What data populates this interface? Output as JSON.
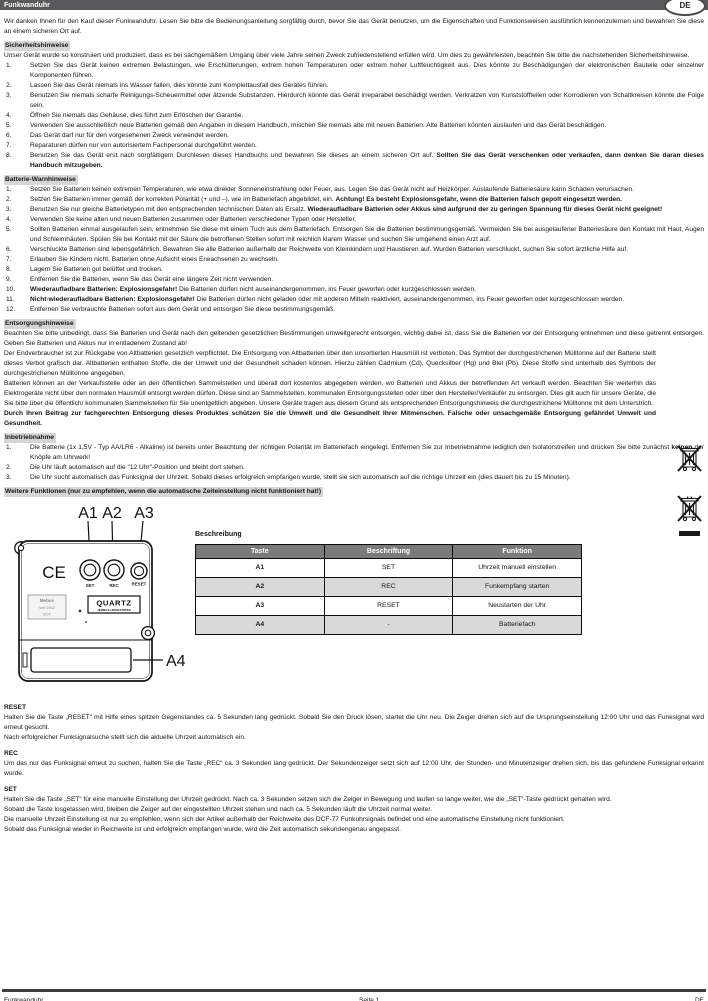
{
  "header": {
    "title": "Funkwanduhr",
    "lang_badge": "DE"
  },
  "intro": "Wir danken Ihnen für den Kauf dieser Funkwanduhr. Lesen Sie bitte die Bedienungsanleitung sorgfältig durch, bevor Sie das Gerät benutzen, um die Eigenschaften und Funktionsweisen ausführlich kennenzulernen und bewahren Sie diese an einem sicheren Ort auf.",
  "safety": {
    "heading": "Sicherheitshinweise",
    "lead": "Unser Gerät wurde so konstruiert und produziert, dass es bei sachgemäßem Umgang über viele Jahre seinen Zweck zufriedenstellend erfüllen wird. Um dies zu gewährleisten, beachten Sie bitte die nachstehenden Sicherheitshinweise.",
    "items": [
      {
        "n": "1.",
        "segs": [
          {
            "t": "Setzen Sie das Gerät keinen extremen Belastungen, wie Erschütterungen, extrem hohen Temperaturen oder extrem hoher Luftfeuchtigkeit aus. Dies könnte zu Beschädigungen der elektronischen Bauteile oder einzelner Komponenten führen."
          }
        ]
      },
      {
        "n": "2.",
        "segs": [
          {
            "t": "Lassen Sie das Gerät niemals ins Wasser fallen, dies könnte zum Komplettausfall des Gerätes führen."
          }
        ]
      },
      {
        "n": "3.",
        "segs": [
          {
            "t": "Benutzen Sie niemals scharfe Reinigungs-Scheuermittel oder ätzende Substanzen. Hierdurch könnte das Gerät irreparabel beschädigt werden. Verkratzen von Kunststoffteilen oder Korrodieren von Schaltkreisen könnte die Folge sein."
          }
        ]
      },
      {
        "n": "4.",
        "segs": [
          {
            "t": "Öffnen Sie niemals das Gehäuse, dies führt zum Erlöschen der Garantie."
          }
        ]
      },
      {
        "n": "5.",
        "segs": [
          {
            "t": "Verwenden Sie ausschließlich neue Batterien gemäß den Angaben in diesem Handbuch, mischen Sie niemals alte mit neuen Batterien. Alte Batterien könnten auslaufen und das Gerät beschädigen."
          }
        ]
      },
      {
        "n": "6.",
        "segs": [
          {
            "t": "Das Gerät darf nur für den vorgesehenen Zweck verwendet werden."
          }
        ]
      },
      {
        "n": "7.",
        "segs": [
          {
            "t": "Reparaturen dürfen nur von autorisiertem Fachpersonal durchgeführt werden."
          }
        ]
      },
      {
        "n": "8.",
        "segs": [
          {
            "t": "Benutzen Sie das Gerät erst nach sorgfältigem Durchlesen dieses Handbuchs und bewahren Sie dieses an einem sicheren Ort auf. "
          },
          {
            "t": "Sollten Sie das Gerät verschenken oder verkaufen, dann denken Sie daran dieses Handbuch mitzugeben.",
            "b": true
          }
        ]
      }
    ]
  },
  "battery": {
    "heading": "Batterie-Warnhinweise",
    "items": [
      {
        "n": "1.",
        "segs": [
          {
            "t": "Setzen Sie Batterien keinen extremen Temperaturen, wie etwa direkter Sonneneinstrahlung oder Feuer, aus. Legen Sie das Gerät nicht auf Heizkörper. Auslaufende Batteriesäure kann Schäden verursachen."
          }
        ]
      },
      {
        "n": "2.",
        "segs": [
          {
            "t": "Setzen Sie Batterien immer gemäß der korrekten Polarität (+ und –), wie im Batteriefach abgebildet, ein. "
          },
          {
            "t": "Achtung! Es besteht Explosionsgefahr, wenn die Batterien falsch gepolt eingesetzt werden.",
            "b": true
          }
        ]
      },
      {
        "n": "3.",
        "segs": [
          {
            "t": "Benutzen Sie nur gleiche Batterietypen mit den entsprechenden technischen Daten als Ersatz. "
          },
          {
            "t": "Wiederaufladbare Batterien oder Akkus sind aufgrund der zu geringen Spannung für dieses Gerät nicht geeignet!",
            "b": true
          }
        ]
      },
      {
        "n": "4.",
        "segs": [
          {
            "t": "Verwenden Sie keine alten und neuen Batterien zusammen oder Batterien verschiedener Typen oder Hersteller."
          }
        ]
      },
      {
        "n": "5.",
        "segs": [
          {
            "t": "Sollten Batterien einmal ausgelaufen sein, entnehmen Sie diese mit einem Tuch aus dem Batteriefach. Entsorgen Sie die Batterien bestimmungsgemäß. Vermeiden Sie bei ausgelaufener Batteriesäure den Kontakt mit Haut, Augen und Schleimhäuten. Spülen Sie bei Kontakt mit der Säure die betroffenen Stellen sofort mit reichlich klarem Wasser und suchen Sie umgehend einen Arzt auf."
          }
        ]
      },
      {
        "n": "6.",
        "segs": [
          {
            "t": "Verschluckte Batterien sind lebensgefährlich. Bewahren Sie alle Batterien außerhalb der Reichweite von Kleinkindern und Haustieren auf. Wurden Batterien verschluckt, suchen Sie sofort ärztliche Hilfe auf."
          }
        ]
      },
      {
        "n": "7.",
        "segs": [
          {
            "t": "Erlauben Sie Kindern nicht, Batterien ohne Aufsicht eines Erwachsenen zu wechseln."
          }
        ]
      },
      {
        "n": "8.",
        "segs": [
          {
            "t": "Lagern Sie Batterien gut belüftet und trocken."
          }
        ]
      },
      {
        "n": "9.",
        "segs": [
          {
            "t": "Entfernen Sie die Batterien, wenn Sie das Gerät eine längere Zeit nicht verwenden."
          }
        ]
      },
      {
        "n": "10.",
        "segs": [
          {
            "t": "Wiederaufladbare Batterien: Explosionsgefahr!",
            "b": true
          },
          {
            "t": " Die Batterien dürfen nicht auseinandergenommen, ins Feuer geworfen oder kurzgeschlossen werden."
          }
        ]
      },
      {
        "n": "11.",
        "segs": [
          {
            "t": "Nicht-wiederaufladbare Batterien: Explosionsgefahr!",
            "b": true
          },
          {
            "t": " Die Batterien dürfen nicht geladen oder mit anderen Mitteln reaktiviert, auseinandergenommen, ins Feuer geworfen oder kurzgeschlossen werden."
          }
        ]
      },
      {
        "n": "12.",
        "segs": [
          {
            "t": "Entfernen Sie verbrauchte Batterien sofort aus dem Gerät und entsorgen Sie diese bestimmungsgemäß."
          }
        ]
      }
    ]
  },
  "disposal": {
    "heading": "Entsorgungshinweise",
    "p1": "Beachten Sie bitte unbedingt, dass Sie Batterien und Gerät nach den geltenden gesetzlichen Bestimmungen umweltgerecht entsorgen, wichtig dabei ist, dass Sie die Batterien vor der Entsorgung entnehmen und diese getrennt entsorgen. Geben Sie Batterien und Akkus nur in entladenem Zustand ab!",
    "p2": "Der Endverbraucher ist zur Rückgabe von Altbatterien gesetzlich verpflichtet. Die Entsorgung von Altbatterien über den unsortierten Hausmüll ist verboten. Das Symbol der durchgestrichenen Mülltonne auf der Batterie stellt dieses Verbot grafisch dar. Altbatterien enthalten Stoffe, die der Umwelt und der Gesundheit schaden können. Hierzu zählen Cadmium (Cd), Quecksilber (Hg) und Blei (Pb). Diese Stoffe sind unterhalb des Symbols der durchgestrichenen Mülltonne angegeben.",
    "p3": "Batterien können an der Verkaufsstelle oder an den öffentlichen Sammelstellen und überall dort kostenlos abgegeben werden, wo Batterien und Akkus der betreffenden Art verkauft werden. Beachten Sie weiterhin das Elektrogeräte nicht über den normalen Hausmüll entsorgt werden dürfen. Diese sind an Sammelstellen, kommunalen Entsorgungsstellen oder über den Hersteller/Verkäufer zu entsorgen. Dies gilt auch für unsere Geräte, die Sie bitte über die öffentlich/ kommunalen Sammelstellen für Sie unentgeltlich abgeben. Unsere Geräte tragen aus diesem Grund als entsprechenden Entsorgungshinweis die durchgestrichene Mülltonne mit dem Unterstrich.",
    "p4": "Durch Ihren Beitrag zur fachgerechten Entsorgung dieses Produktes schützen Sie die Umwelt und die Gesundheit Ihrer Mitmenschen. Falsche oder unsachgemäße Entsorgung gefährdet Umwelt und Gesundheit."
  },
  "setup": {
    "heading": "Inbetriebnahme",
    "items": [
      {
        "n": "1.",
        "segs": [
          {
            "t": "Die Batterie (1x 1,5V - Typ AA/LR6 - Alkaline) ist bereits unter Beachtung der richtigen Polarität im Batteriefach eingelegt. Entfernen Sie zur Inbetriebnahme lediglich den Isolatorstreifen und drücken Sie bitte zunächst "
          },
          {
            "t": "keinen",
            "b": true
          },
          {
            "t": " der Knöpfe am Uhrwerk!"
          }
        ]
      },
      {
        "n": "2.",
        "segs": [
          {
            "t": "Die Uhr läuft automatisch auf die \"12 Uhr\"-Position und bleibt dort stehen."
          }
        ]
      },
      {
        "n": "3.",
        "segs": [
          {
            "t": "Die Uhr sucht automatisch das Funksignal der Uhrzeit. Sobald dieses erfolgreich empfangen wurde, stellt sie sich automatisch auf die richtige Uhrzeit ein (dies dauert bis zu 15 Minuten)."
          }
        ]
      }
    ]
  },
  "more": {
    "heading": "Weitere Funktionen (nur zu empfehlen, wenn die automatische Zeiteinstellung nicht funktioniert hat!)"
  },
  "diagram": {
    "label_a1": "A1",
    "label_a2": "A2",
    "label_a3": "A3",
    "label_a4": "A4",
    "btn_set": "SET",
    "btn_rec": "REC",
    "btn_reset": "RESET",
    "ce_mark": "CE",
    "quartz": "QUARTZ",
    "quartz_sub": "JEWELS UNADJUSTED",
    "sticker_line1": "Mebus",
    "sticker_line2": "seit 1902",
    "sticker_line3": "DCF"
  },
  "table": {
    "title": "Beschreibung",
    "headers": [
      "Taste",
      "Beschriftung",
      "Funktion"
    ],
    "rows": [
      [
        "A1",
        "SET",
        "Uhrzeit manuell einstellen"
      ],
      [
        "A2",
        "REC",
        "Funkempfang starten"
      ],
      [
        "A3",
        "RESET",
        "Neustarten der Uhr"
      ],
      [
        "A4",
        "-",
        "Batteriefach"
      ]
    ]
  },
  "reset": {
    "heading": "RESET",
    "p1": "Halten Sie die Taste „RESET“ mit Hilfe eines spitzen Gegenstandes ca. 5 Sekunden lang gedrückt. Sobald Sie den Druck lösen, startet die Uhr neu. Die Zeiger drehen sich auf die Ursprungseinstellung 12:00 Uhr und das Funksignal wird erneut gesucht.",
    "p2": "Nach erfolgreicher Funksignalsuche stellt sich die aktuelle Uhrzeit automatisch ein."
  },
  "rec": {
    "heading": "REC",
    "p1": "Um das nur das Funksignal erneut zu suchen, halten Sie die Taste „REC“ ca. 3 Sekunden lang gedrückt. Der Sekundenzeiger setzt sich auf 12:00 Uhr, der Stunden- und Minutenzeiger drehen sich, bis das gefundene Funksignal erkannt wurde."
  },
  "set": {
    "heading": "SET",
    "p1": "Halten Sie die Taste „SET“ für eine manuelle Einstellung der Uhrzeit gedrückt. Nach ca. 3 Sekunden setzen sich die Zeiger in Bewegung und laufen so lange weiter, wie die „SET“-Taste gedrückt gehalten wird.",
    "p2": "Sobald die Taste losgelassen wird, bleiben die Zeiger auf der eingestellten Uhrzeit stehen und nach ca. 5 Sekunden läuft die Uhrzeit normal weiter.",
    "p3": "Die manuelle Uhrzeit Einstellung ist nur zu empfehlen, wenn sich der Artikel außerhalb der Reichweite des DCF-77 Funkuhrsignals befindet und eine automatische Einstellung nicht funktioniert.",
    "p4": "Sobald das Funksignal wieder in Reichweite ist und erfolgreich empfangen wurde, wird die Zeit automatisch sekundengenau angepasst."
  },
  "footer": {
    "left": "Funkwanduhr",
    "center": "Seite 1",
    "right": "DE"
  }
}
